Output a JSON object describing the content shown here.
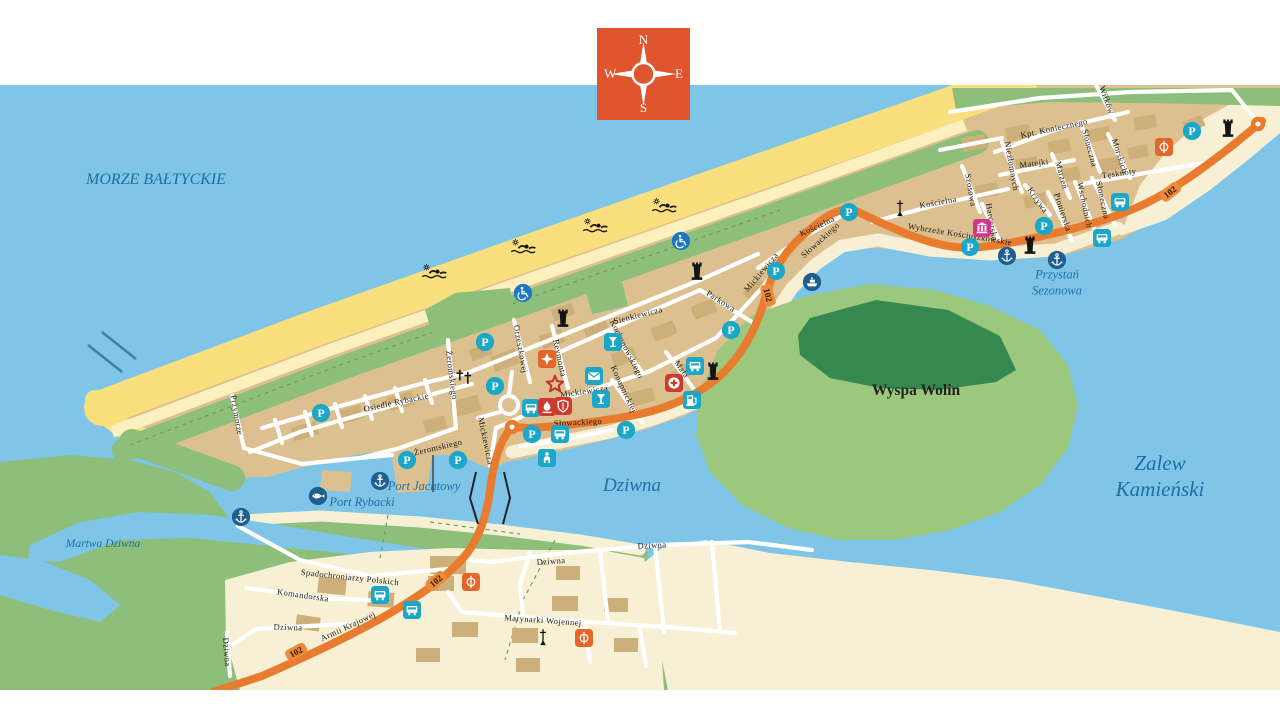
{
  "compass": {
    "north": "N",
    "south": "S",
    "east": "E",
    "west": "W"
  },
  "colors": {
    "sea": "#7ec5e8",
    "beach": "#fadf7e",
    "pale_sand": "#fcf0be",
    "dune_green": "#8dbf7a",
    "forest": "#35884f",
    "town_tan": "#dcc08f",
    "building": "#cdaf79",
    "cream": "#f7f0d4",
    "route": "#e87b2e",
    "teal_icon": "#1ba7c8",
    "navy_icon": "#1e5f8f",
    "access_blue": "#1a77c2",
    "red_icon": "#ce3a30",
    "pink_icon": "#d2368c",
    "orange_icon": "#e4662b",
    "water_label": "#1e6fa5"
  },
  "map": {
    "water_labels": [
      {
        "lines": [
          "MORZE BAŁTYCKIE"
        ],
        "x": 156,
        "y": 180,
        "size": 16
      },
      {
        "lines": [
          "Dziwna"
        ],
        "x": 632,
        "y": 486,
        "size": 19
      },
      {
        "lines": [
          "Martwa Dziwna"
        ],
        "x": 103,
        "y": 544,
        "size": 11.5
      },
      {
        "lines": [
          "Zalew",
          "Kamieński"
        ],
        "x": 1160,
        "y": 476,
        "size": 21
      },
      {
        "lines": [
          "Przystań",
          "Sezonowa"
        ],
        "x": 1057,
        "y": 283,
        "size": 12.5
      },
      {
        "lines": [
          "Port Jachtowy"
        ],
        "x": 424,
        "y": 487,
        "size": 12.5
      },
      {
        "lines": [
          "Port Rybacki"
        ],
        "x": 362,
        "y": 503,
        "size": 12.5
      }
    ],
    "land_labels": [
      {
        "text": "Wyspa Wolin",
        "x": 916,
        "y": 391,
        "size": 15.5
      }
    ],
    "street_labels_format": "[text, x, y, rotation_deg]",
    "street_labels": [
      [
        "Przymorze",
        237,
        415,
        80
      ],
      [
        "Osiedle Rybackie",
        396,
        402,
        -12
      ],
      [
        "Żeromskiego",
        452,
        375,
        83
      ],
      [
        "Żeromskiego",
        438,
        447,
        -13
      ],
      [
        "Orzeszkowej",
        521,
        349,
        80
      ],
      [
        "Reymonta",
        560,
        358,
        78
      ],
      [
        "Sienkiewicza",
        638,
        315,
        -14
      ],
      [
        "Kochanowskiego",
        627,
        349,
        63
      ],
      [
        "Konopnickiej",
        624,
        389,
        65
      ],
      [
        "Mickiewicza",
        584,
        391,
        -8
      ],
      [
        "Mickiewicza",
        761,
        272,
        -50
      ],
      [
        "Mickiewicza",
        486,
        441,
        78
      ],
      [
        "Słowackiego",
        578,
        422,
        -3
      ],
      [
        "Słowackiego",
        820,
        240,
        -42
      ],
      [
        "Parkowa",
        721,
        301,
        33
      ],
      [
        "Mała",
        682,
        369,
        55
      ],
      [
        "Kościelna",
        817,
        226,
        -25
      ],
      [
        "Kościelna",
        938,
        202,
        -10
      ],
      [
        "Wybrzeże Kościuszkowskie",
        960,
        234,
        9
      ],
      [
        "Wilków",
        1107,
        100,
        70
      ],
      [
        "Kpt. Koniecznego",
        1054,
        128,
        -12
      ],
      [
        "Słoneczna",
        1090,
        148,
        75
      ],
      [
        "Słoneczna",
        1103,
        200,
        78
      ],
      [
        "Morskich",
        1120,
        156,
        72
      ],
      [
        "Niezłomnych",
        1012,
        166,
        80
      ],
      [
        "Matejki",
        1034,
        163,
        -8
      ],
      [
        "Marzeń",
        1062,
        175,
        75
      ],
      [
        "Tęsknoty",
        1119,
        173,
        -8
      ],
      [
        "Szosowa",
        971,
        190,
        80
      ],
      [
        "Harcerska",
        992,
        222,
        80
      ],
      [
        "Krzywa",
        1038,
        200,
        55
      ],
      [
        "Pionierska",
        1063,
        212,
        72
      ],
      [
        "Wschodnich",
        1085,
        205,
        78
      ],
      [
        "Spadochroniarzy Polskich",
        350,
        577,
        6
      ],
      [
        "Komandorska",
        303,
        595,
        8
      ],
      [
        "Dziwna",
        288,
        627,
        2
      ],
      [
        "Dziwna",
        227,
        652,
        85
      ],
      [
        "Dziwna",
        551,
        561,
        -4
      ],
      [
        "Dziwna",
        652,
        545,
        -3
      ],
      [
        "Marynarki Wojennej",
        543,
        620,
        4
      ],
      [
        "Armii Krajowej",
        348,
        626,
        -25
      ]
    ],
    "road_number": "102",
    "road_badges_format": "[text, x, y, rotation_deg]",
    "road_badges": [
      [
        "102",
        1170,
        192,
        -38
      ],
      [
        "102",
        768,
        295,
        75
      ],
      [
        "102",
        436,
        581,
        -40
      ],
      [
        "102",
        296,
        652,
        -28
      ]
    ],
    "markers_format": "[type, x, y]",
    "markers": [
      [
        "parking",
        1192,
        131
      ],
      [
        "parking",
        1044,
        226
      ],
      [
        "parking",
        970,
        247
      ],
      [
        "parking",
        849,
        212
      ],
      [
        "parking",
        776,
        271
      ],
      [
        "parking",
        731,
        330
      ],
      [
        "parking",
        485,
        342
      ],
      [
        "parking",
        495,
        386
      ],
      [
        "parking",
        532,
        434
      ],
      [
        "parking",
        626,
        430
      ],
      [
        "parking",
        321,
        413
      ],
      [
        "parking",
        407,
        460
      ],
      [
        "parking",
        458,
        460
      ],
      [
        "bus-stop",
        1120,
        202
      ],
      [
        "bus-stop",
        1102,
        238
      ],
      [
        "bus-stop",
        695,
        366
      ],
      [
        "bus-stop",
        531,
        408
      ],
      [
        "bus-stop",
        560,
        434
      ],
      [
        "bus-stop",
        380,
        595
      ],
      [
        "bus-stop",
        412,
        610
      ],
      [
        "bar",
        613,
        342
      ],
      [
        "bar",
        601,
        399
      ],
      [
        "post-office",
        594,
        376
      ],
      [
        "fuel-station",
        692,
        400
      ],
      [
        "toilets",
        547,
        458
      ],
      [
        "pharmacy",
        674,
        383
      ],
      [
        "memorial-flame",
        547,
        407
      ],
      [
        "shield",
        563,
        406
      ],
      [
        "museum",
        982,
        228
      ],
      [
        "monument",
        1164,
        147
      ],
      [
        "monument",
        471,
        582
      ],
      [
        "monument",
        584,
        638
      ],
      [
        "star-landmark",
        547,
        359
      ],
      [
        "monument-star",
        555,
        384
      ],
      [
        "anchor-marina",
        1007,
        256
      ],
      [
        "anchor-marina",
        1057,
        260
      ],
      [
        "anchor-marina",
        380,
        481
      ],
      [
        "anchor-marina",
        241,
        517
      ],
      [
        "fishing-port",
        318,
        496
      ],
      [
        "ferry",
        812,
        282
      ],
      [
        "accessible-beach",
        523,
        293
      ],
      [
        "accessible-beach",
        681,
        241
      ],
      [
        "watch-tower",
        1228,
        128
      ],
      [
        "watch-tower",
        1030,
        245
      ],
      [
        "watch-tower",
        697,
        271
      ],
      [
        "watch-tower",
        713,
        371
      ],
      [
        "watch-tower",
        563,
        318
      ],
      [
        "church",
        900,
        208
      ],
      [
        "church",
        543,
        637
      ],
      [
        "cemetery",
        465,
        377
      ],
      [
        "swimmer",
        435,
        272
      ],
      [
        "swimmer",
        524,
        247
      ],
      [
        "swimmer",
        596,
        226
      ],
      [
        "swimmer",
        665,
        206
      ],
      [
        "road-junction",
        1258,
        124
      ],
      [
        "road-junction",
        512,
        427
      ]
    ]
  }
}
